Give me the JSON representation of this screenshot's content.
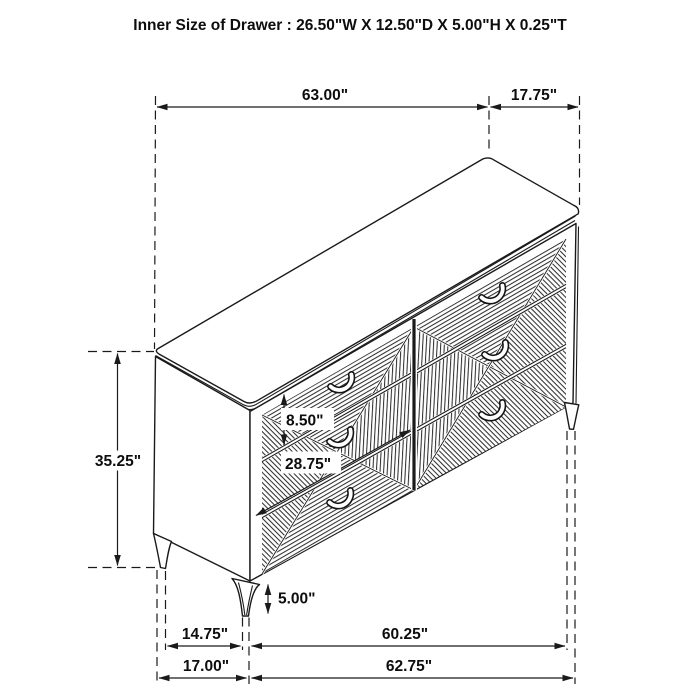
{
  "title": "Inner Size of Drawer : 26.50\"W X 12.50\"D X 5.00\"H X 0.25\"T",
  "diagram": {
    "subject": "six-drawer dresser isometric line drawing",
    "line_color": "#1a1a1a",
    "background_color": "#ffffff"
  },
  "dimensions": {
    "top_width": "63.00\"",
    "top_depth": "17.75\"",
    "body_height": "35.25\"",
    "drawer_front_height": "8.50\"",
    "drawer_front_width": "28.75\"",
    "leg_height": "5.00\"",
    "base_depth_span": "14.75\"",
    "base_width_span": "60.25\"",
    "floor_depth": "17.00\"",
    "floor_width": "62.75\""
  }
}
